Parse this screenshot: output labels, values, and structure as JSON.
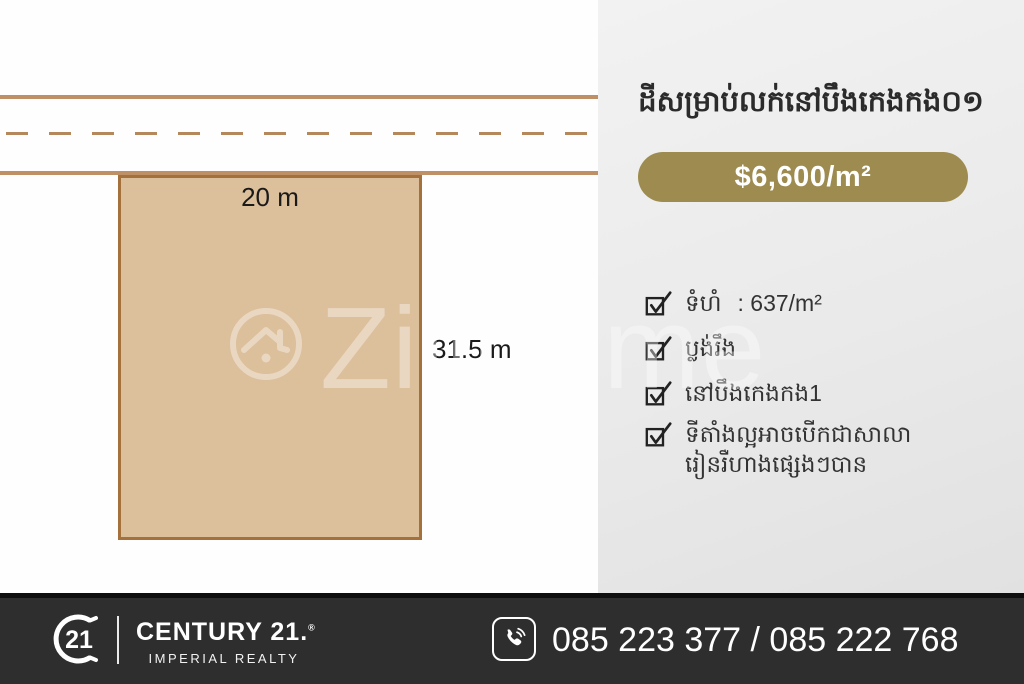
{
  "plot_diagram": {
    "width_label": "20 m",
    "depth_label": "31.5 m"
  },
  "watermark": {
    "icon": "house-circle-icon",
    "text": "Zillhome"
  },
  "listing": {
    "title": "ដីសម្រាប់លក់នៅបឹងកេងកង០១",
    "price": "$6,600/m²",
    "features": [
      {
        "label": "ទំហំ",
        "value": ": 637/m²"
      },
      {
        "label": "ប្លង់រឹង",
        "value": ""
      },
      {
        "label": "នៅបឹងកេងកង1",
        "value": ""
      },
      {
        "label": "ទីតាំងល្អអាចបើកជាសាលា\nរៀនរឺហាងផ្សេងៗបាន",
        "value": ""
      }
    ]
  },
  "footer": {
    "logo_text": "21",
    "brand": "CENTURY 21.",
    "registered": "®",
    "sub_brand": "IMPERIAL REALTY",
    "phones": "085 223 377 / 085 222 768"
  },
  "colors": {
    "accent_gold": "#9d8b4f",
    "plot_fill": "#dcbf9b",
    "plot_border": "#a4703c",
    "road_line": "#bf9066",
    "footer_bg": "#2e2e2e"
  }
}
